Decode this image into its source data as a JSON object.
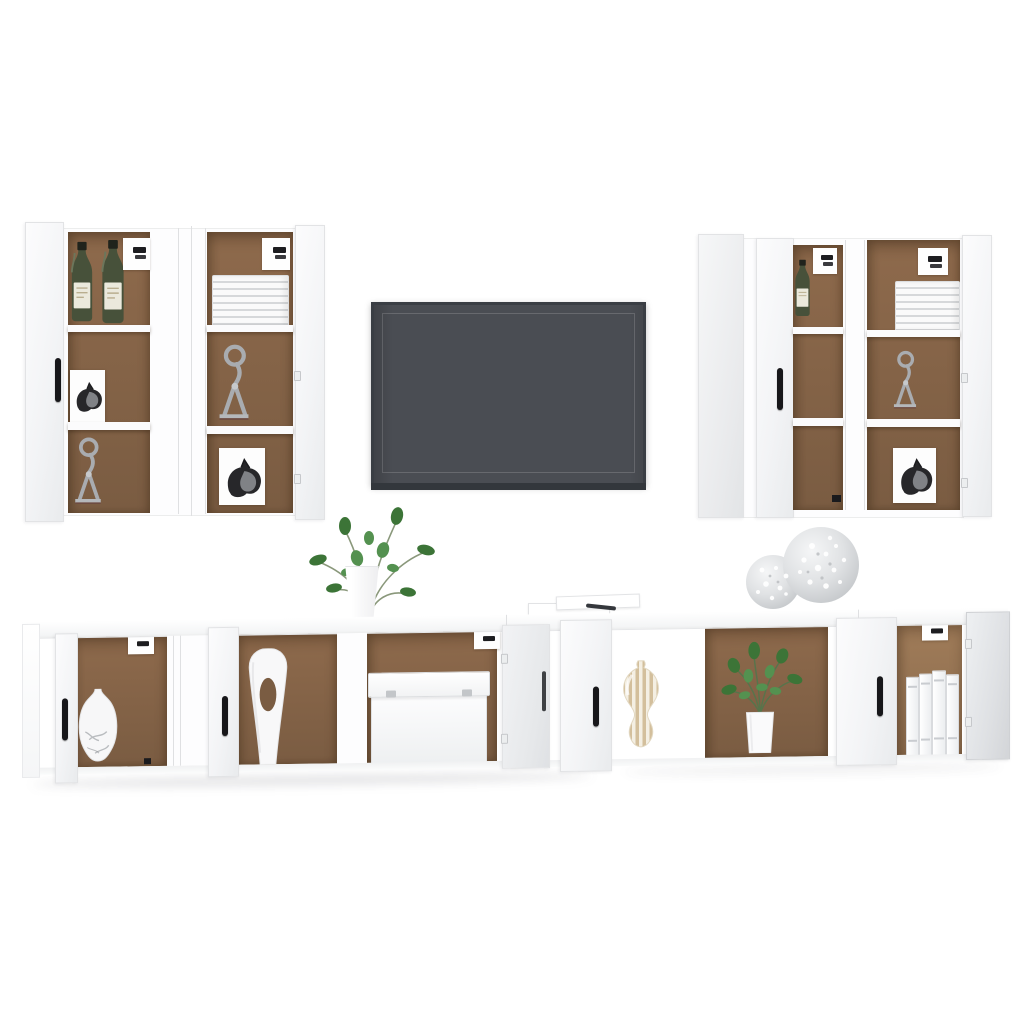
{
  "scene": {
    "type": "furniture product photo",
    "description": "8-piece white engineered-wood TV wall unit set: four tall wall-mounted cabinets with open doors flanking a wall-mounted flat-screen TV, above a long floating TV bench with open compartments, decorated with vases, plants, plates, sculptures, books and ornaments",
    "background": "#ffffff"
  },
  "colors": {
    "background_white": "#ffffff",
    "cabinet_white": "#fdfdfe",
    "cabinet_edge": "#e6e7e9",
    "interior_brown": "#8e6a4c",
    "interior_brown_dark": "#7a5c42",
    "handle_black": "#17171a",
    "tv_screen": "#4a4d53",
    "tv_frame": "#3a3e44",
    "tv_bar": "#33373c",
    "bottle_green": "#47513a",
    "sculpture_silver": "#a9acb0",
    "leaf_green": "#3c7437",
    "stripe_beige": "#d3bf9c",
    "shadow_gray": "#d7d8da"
  },
  "objects": {
    "stage": {
      "label": "white TV wall unit furniture set product photo"
    },
    "cabinet_group_left": {
      "label": "two tall white wall cabinets with open doors"
    },
    "cabinet_group_right": {
      "label": "two tall white wall cabinets with open doors"
    },
    "tv": {
      "label": "wall-mounted dark gray flat-screen TV"
    },
    "bench": {
      "label": "long white floating TV bench with open doors and compartments"
    },
    "wine_bottles": {
      "label": "green wine bottles on cabinet shelf"
    },
    "plate_stack": {
      "label": "stack of white plates"
    },
    "cat_sculpture": {
      "label": "silver wire cat sculpture on base"
    },
    "horse_print": {
      "label": "horse head sketch print card"
    },
    "mounting_bracket": {
      "label": "black wall-mount bracket plate"
    },
    "door_handle": {
      "label": "black door handle"
    },
    "marble_vase": {
      "label": "white marble-pattern bulb vase"
    },
    "cutout_vase": {
      "label": "tall white vase with oval cutout"
    },
    "storage_box": {
      "label": "white storage box with lid"
    },
    "striped_vase": {
      "label": "beige striped gourd vase"
    },
    "leafy_plant": {
      "label": "leafy green plant in white vase on bench top"
    },
    "potted_plant": {
      "label": "green potted plant in bench compartment"
    },
    "magazines": {
      "label": "white magazines with pen on bench top"
    },
    "baubles": {
      "label": "two silver glitter baubles on bench top"
    },
    "binders": {
      "label": "white ring binders in compartment"
    }
  }
}
